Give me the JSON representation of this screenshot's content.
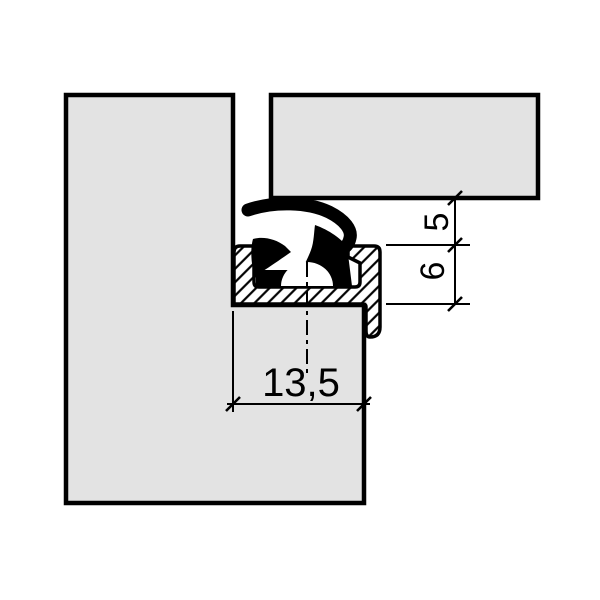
{
  "dimensions": {
    "top_gap": "5",
    "channel_height": "6",
    "channel_width": "13,5"
  },
  "colors": {
    "profile_fill": "#e3e3e3",
    "outline": "#000000",
    "seal_fill": "#000000",
    "background": "#ffffff"
  }
}
